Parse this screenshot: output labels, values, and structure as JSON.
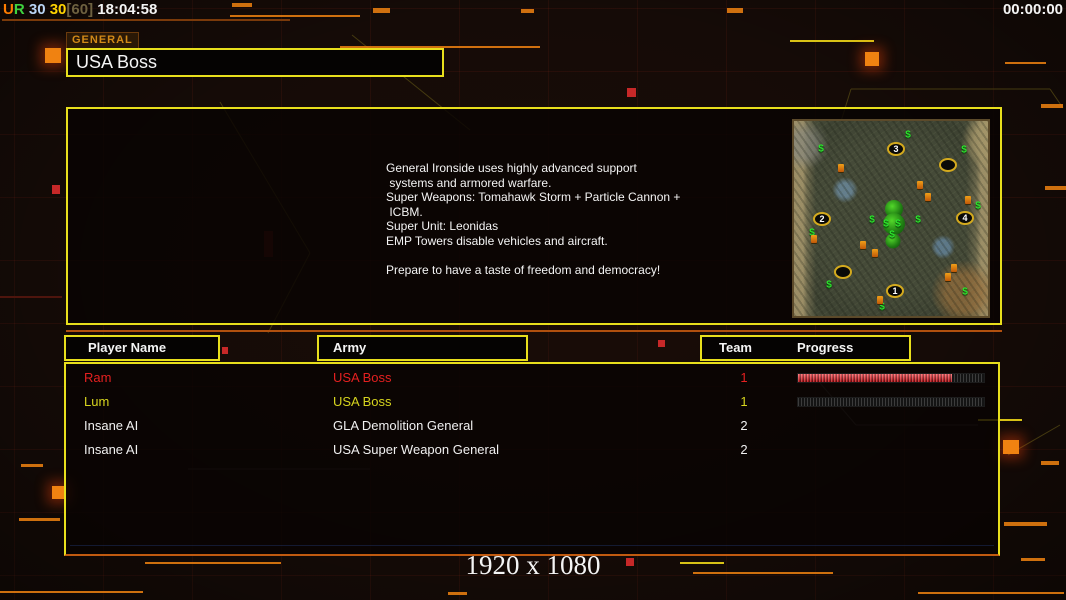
{
  "header": {
    "counter_segments": [
      "U",
      "R",
      " 30",
      " 30",
      "[60]",
      " 18:04:58"
    ],
    "clock": "00:00:00"
  },
  "general": {
    "tab_label": "GENERAL",
    "name": "USA Boss",
    "description": "General Ironside uses highly advanced support\n systems and armored warfare.\nSuper Weapons: Tomahawk Storm + Particle Cannon +\n ICBM.\nSuper Unit: Leonidas\nEMP Towers disable vehicles and aircraft.\n\nPrepare to have a taste of freedom and democracy!"
  },
  "minimap": {
    "spawn_points": [
      {
        "label": "1",
        "x": 101,
        "y": 170
      },
      {
        "label": "2",
        "x": 28,
        "y": 98
      },
      {
        "label": "3",
        "x": 102,
        "y": 28
      },
      {
        "label": "4",
        "x": 171,
        "y": 97
      }
    ],
    "empty_slots": [
      {
        "x": 154,
        "y": 44
      },
      {
        "x": 49,
        "y": 151
      }
    ],
    "supply_money": [
      [
        114,
        14
      ],
      [
        27,
        28
      ],
      [
        170,
        29
      ],
      [
        184,
        85
      ],
      [
        78,
        99
      ],
      [
        124,
        99
      ],
      [
        18,
        112
      ],
      [
        35,
        164
      ],
      [
        88,
        186
      ],
      [
        171,
        171
      ],
      [
        92,
        103
      ],
      [
        104,
        103
      ],
      [
        98,
        114
      ]
    ],
    "oil_derricks": [
      [
        47,
        47
      ],
      [
        126,
        64
      ],
      [
        134,
        76
      ],
      [
        69,
        124
      ],
      [
        81,
        132
      ],
      [
        154,
        156
      ],
      [
        86,
        179
      ],
      [
        174,
        79
      ],
      [
        20,
        118
      ],
      [
        160,
        147
      ]
    ],
    "tree_clusters": [
      [
        100,
        88,
        18
      ],
      [
        100,
        103,
        22
      ],
      [
        99,
        120,
        15
      ]
    ]
  },
  "table": {
    "headers": {
      "player": "Player Name",
      "army": "Army",
      "team": "Team",
      "progress": "Progress"
    },
    "rows": [
      {
        "name": "Ram",
        "army": "USA Boss",
        "team": "1",
        "progress": 83,
        "has_bar": true
      },
      {
        "name": "Lum",
        "army": "USA Boss",
        "team": "1",
        "progress": 0,
        "has_bar": true
      },
      {
        "name": "Insane AI",
        "army": "GLA Demolition General",
        "team": "2",
        "has_bar": false
      },
      {
        "name": "Insane AI",
        "army": "USA Super Weapon General",
        "team": "2",
        "has_bar": false
      }
    ]
  },
  "footer": {
    "resolution": "1920 x 1080"
  },
  "colors": {
    "border_yellow": "#e8df1c",
    "accent_orange": "#f08211",
    "line_orange": "#b0500e",
    "dash_yellow": "#d8c216",
    "red_square": "#c62828",
    "player_red": "#e42020",
    "player_yellow": "#d6d41e",
    "player_white": "#f0f0f0",
    "progress_red": "#d01418",
    "tab_gold": "#d28a18",
    "counter_orange": "#ff7d00",
    "counter_green": "#3fd43f",
    "counter_blue": "#b9d4f4",
    "counter_yellow": "#ffd301",
    "counter_dim": "#6e6140",
    "money_green": "#2ce22c",
    "text_white": "#f4f4f4"
  },
  "decor": {
    "orange_dashes": [
      [
        232,
        3,
        20,
        4
      ],
      [
        373,
        8,
        17,
        5
      ],
      [
        521,
        9,
        13,
        4
      ],
      [
        727,
        8,
        16,
        5
      ],
      [
        230,
        15,
        130,
        2
      ],
      [
        340,
        46,
        200,
        2
      ],
      [
        1005,
        62,
        41,
        2
      ],
      [
        1041,
        104,
        22,
        4
      ],
      [
        1045,
        186,
        21,
        4
      ],
      [
        1041,
        461,
        18,
        4
      ],
      [
        1004,
        522,
        43,
        4
      ],
      [
        1021,
        558,
        24,
        3
      ],
      [
        21,
        464,
        22,
        3
      ],
      [
        19,
        518,
        41,
        3
      ],
      [
        145,
        562,
        136,
        2
      ],
      [
        0,
        591,
        143,
        2
      ],
      [
        448,
        592,
        19,
        3
      ],
      [
        693,
        572,
        140,
        2
      ],
      [
        918,
        592,
        146,
        2
      ]
    ],
    "yellow_dashes": [
      [
        978,
        419,
        44,
        2
      ],
      [
        680,
        562,
        44,
        2
      ],
      [
        790,
        40,
        84,
        2
      ]
    ],
    "orange_squares": [
      [
        865,
        52,
        14,
        14
      ],
      [
        45,
        48,
        16,
        15
      ],
      [
        1003,
        440,
        16,
        14
      ],
      [
        52,
        486,
        14,
        13
      ]
    ],
    "red_squares": [
      [
        52,
        185,
        8,
        9
      ],
      [
        627,
        88,
        9,
        9
      ],
      [
        222,
        347,
        6,
        7
      ],
      [
        658,
        340,
        7,
        7
      ],
      [
        929,
        271,
        5,
        5
      ],
      [
        626,
        558,
        8,
        8
      ]
    ],
    "dark_red_squares": [
      [
        264,
        231,
        9,
        26
      ],
      [
        0,
        296,
        62,
        2
      ]
    ],
    "hex_lines": [
      [
        838,
        131,
        851,
        89
      ],
      [
        851,
        89,
        1050,
        89
      ],
      [
        1050,
        89,
        1063,
        108
      ],
      [
        352,
        35,
        470,
        130
      ],
      [
        220,
        102,
        310,
        253
      ],
      [
        310,
        253,
        268,
        333
      ],
      [
        1008,
        455,
        1060,
        425
      ]
    ],
    "faint_lines": [
      [
        820,
        383,
        856,
        425
      ],
      [
        856,
        425,
        978,
        425
      ],
      [
        188,
        469,
        370,
        469
      ]
    ]
  }
}
